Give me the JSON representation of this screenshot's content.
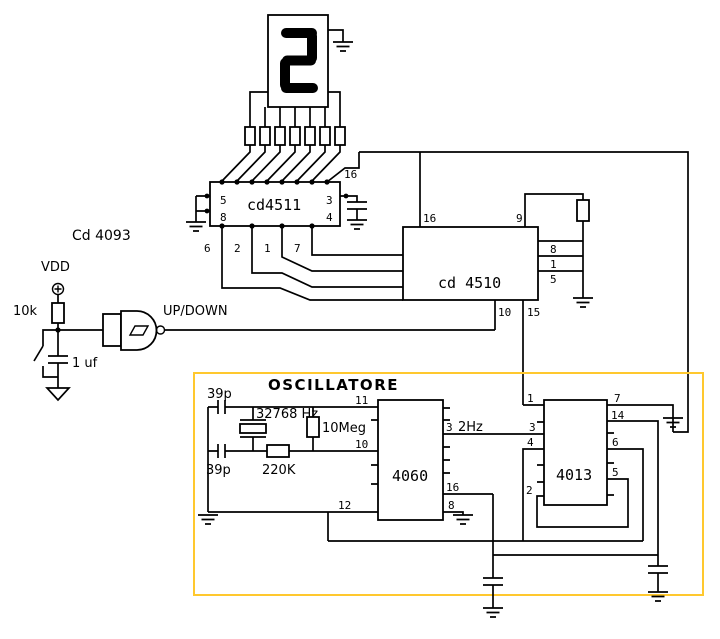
{
  "colors": {
    "wire": "#000000",
    "osc_border": "#FFC82E",
    "osc_title": "#EFA400"
  },
  "display": {
    "digit": "2"
  },
  "components": {
    "osc_title": "OSCILLATORE",
    "decoder": "cd4511",
    "counter": "cd 4510",
    "oscillator_ic": "4060",
    "flipflop_ic": "4013",
    "gate_ic": "Cd 4093",
    "supply": "VDD",
    "pullup_res": "10k",
    "debounce_cap": "1 uf",
    "gate_output": "UP/DOWN",
    "crystal": "32768 Hz",
    "feedback_res": "10Meg",
    "series_res": "220K",
    "cap_top": "39p",
    "cap_bottom": "39p",
    "clock_freq": "2Hz"
  },
  "pins": {
    "n1": "1",
    "n2": "2",
    "n3": "3",
    "n4": "4",
    "n5": "5",
    "n6": "6",
    "n7": "7",
    "n8": "8",
    "n9": "9",
    "n10": "10",
    "n11": "11",
    "n12": "12",
    "n14": "14",
    "n15": "15",
    "n16": "16"
  }
}
